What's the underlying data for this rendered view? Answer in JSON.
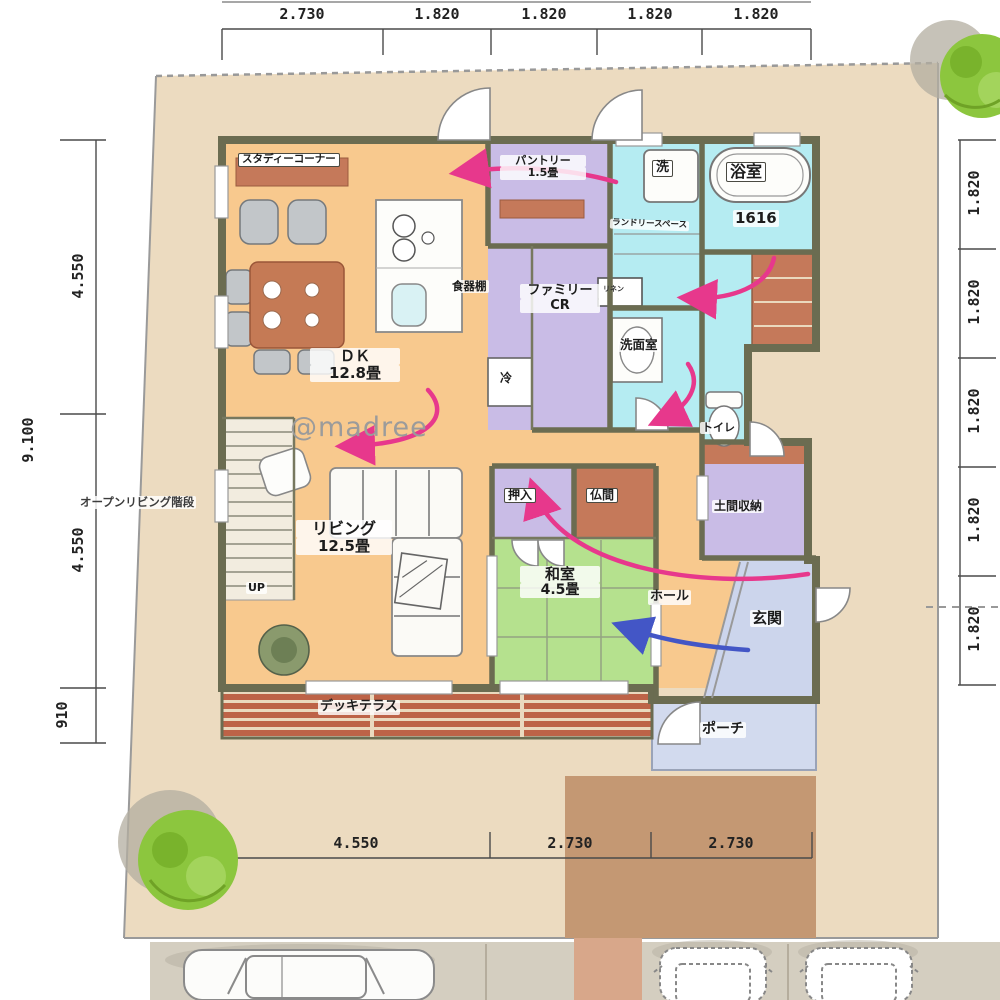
{
  "watermark": "@madree",
  "dimensions": {
    "top": [
      "2.730",
      "1.820",
      "1.820",
      "1.820",
      "1.820"
    ],
    "bottom": [
      "4.550",
      "2.730",
      "2.730"
    ],
    "left": {
      "overall": "9.100",
      "segments": [
        "4.550",
        "4.550",
        "910"
      ]
    },
    "right": [
      "1.820",
      "1.820",
      "1.820",
      "1.820",
      "1.820"
    ]
  },
  "rooms": {
    "study_corner": "スタディーコーナー",
    "pantry_name": "パントリー",
    "pantry_size": "1.5畳",
    "bath_name": "浴室",
    "bath_size": "1616",
    "laundry": "ランドリースペース",
    "family_cr_line1": "ファミリー",
    "family_cr_line2": "CR",
    "washroom": "洗面室",
    "dk_name": "ＤＫ",
    "dk_size": "12.8畳",
    "toilet": "トイレ",
    "living_name": "リビング",
    "living_size": "12.5畳",
    "oshiire": "押入",
    "butsuma": "仏間",
    "doma": "土間収納",
    "washitsu_name": "和室",
    "washitsu_size": "4.5畳",
    "hall": "ホール",
    "genkan": "玄関",
    "porch": "ポーチ",
    "deck": "デッキテラス",
    "open_stairs": "オープンリビング階段"
  },
  "fixtures": {
    "washer": "洗",
    "fridge": "冷",
    "dish_shelf": "食器棚",
    "linen": "リネン",
    "up": "UP"
  },
  "colors": {
    "site": "#ecdbc0",
    "floor_orange": "#f8c98e",
    "tatami_green": "#b5e18e",
    "wet_cyan": "#b5ecf2",
    "closet_purple": "#c9bce6",
    "entrance_blue": "#ccd5ec",
    "wood_terracotta": "#c5795a",
    "wall": "#6b6c51",
    "deck_plank": "#bd6347",
    "driveway": "#c49873",
    "arrow_pink": "#e7388c",
    "arrow_blue": "#4356c6",
    "tree_green": "#8cc63e",
    "dim_text": "#222222",
    "watermark_gray": "#9b9b9b"
  }
}
